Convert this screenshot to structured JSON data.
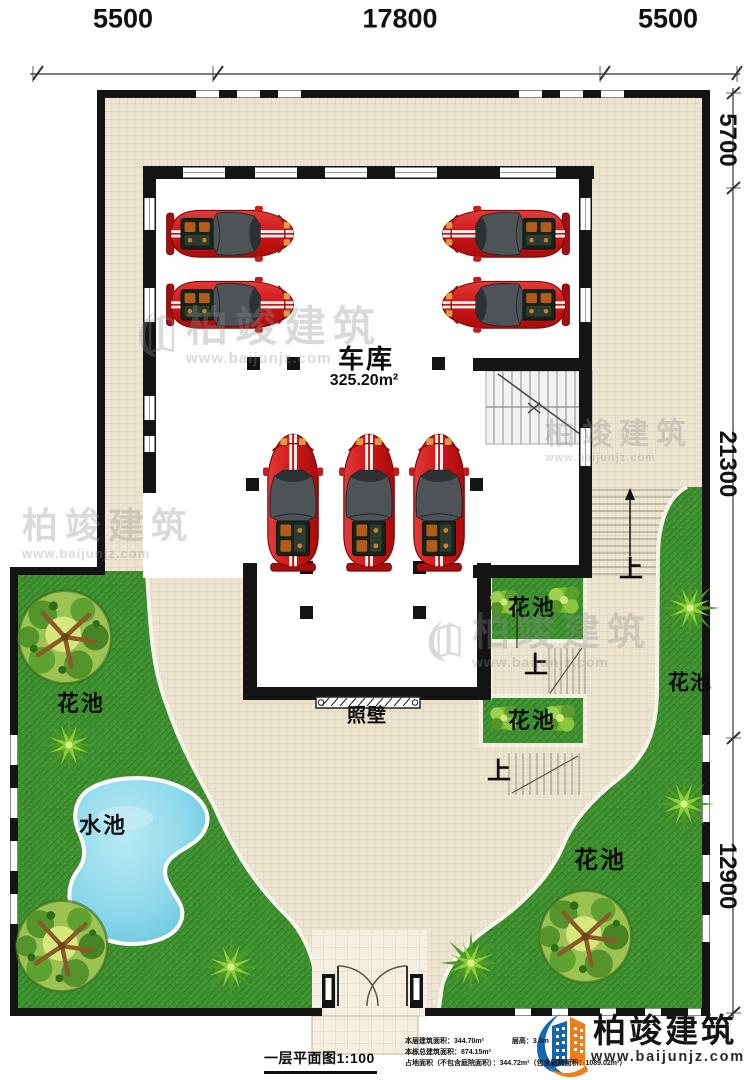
{
  "dimensions": {
    "top": [
      "5500",
      "17800",
      "5500"
    ],
    "right": [
      "5700",
      "21300",
      "12900"
    ]
  },
  "plan_labels": {
    "garage_name": "车库",
    "garage_area": "325.20m²",
    "flower_bed": "花池",
    "water_pool": "水池",
    "screen_wall": "照壁",
    "stairs_up": "上"
  },
  "title_block": {
    "drawing_title": "一层平面图1:100",
    "line1_left": "本层建筑面积：344.70m²",
    "line1_right": "层高：3.3m",
    "line2": "本栋总建筑面积：874.15m²",
    "line3": "占地面积（不包含庭院面积）：344.72m²（包含庭院面积：1089.02m²）"
  },
  "brand": {
    "name": "柏竣建筑",
    "url": "www.baijunjz.com"
  },
  "watermark": {
    "name": "柏竣建筑",
    "url": "www.baijunjz.com"
  }
}
